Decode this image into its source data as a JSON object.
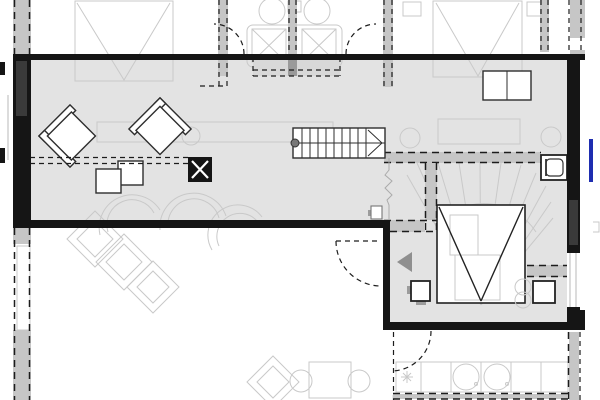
{
  "meta": {
    "drawing_kind": "architectural-floor-plan",
    "description": "Upper-level floor plan; current storey shaded gray, adjacent storeys ghosted in light gray, walls above shown dashed",
    "visible_text": []
  },
  "colors": {
    "bg": "#ffffff",
    "floor_gray": "#e3e3e3",
    "band_gray": "#c6c6c6",
    "niche_gray": "#d8d8d8",
    "stub_gray": "#9a9a9a",
    "wall_black": "#151515",
    "wall_inner": "#3a3a3a",
    "ghost_line": "#c9c9c9",
    "furniture_line": "#2e2e2e",
    "dash_dark": "#1c1c1c",
    "glazing_line": "#b9b9b9",
    "break_line": "#ababab",
    "accent_blue": "#1e2db0",
    "arrow_gray": "#8f8f8f",
    "tab_gray": "#9c9c9c"
  },
  "elements": {
    "zones": [
      "open-living-area-current-floor",
      "lounge-corner",
      "lower-left-room-below",
      "kitchen-room-below",
      "bathroom-above-ghost",
      "bedroom-above-left-ghost",
      "bedroom-above-right-ghost"
    ],
    "symbols": [
      "straight-stair",
      "winder-stair-ghost",
      "void-v-marking",
      "wood-stove-icon",
      "armchair-icon",
      "side-table-icon",
      "desk-icon",
      "washbasin-icon",
      "shower-tray-icon",
      "basin-circle-icon",
      "door-swing-arc",
      "direction-arrow",
      "window-glazing",
      "freezer-snowflake-icon",
      "sink-circle-icon",
      "accent-marker-blue"
    ]
  }
}
